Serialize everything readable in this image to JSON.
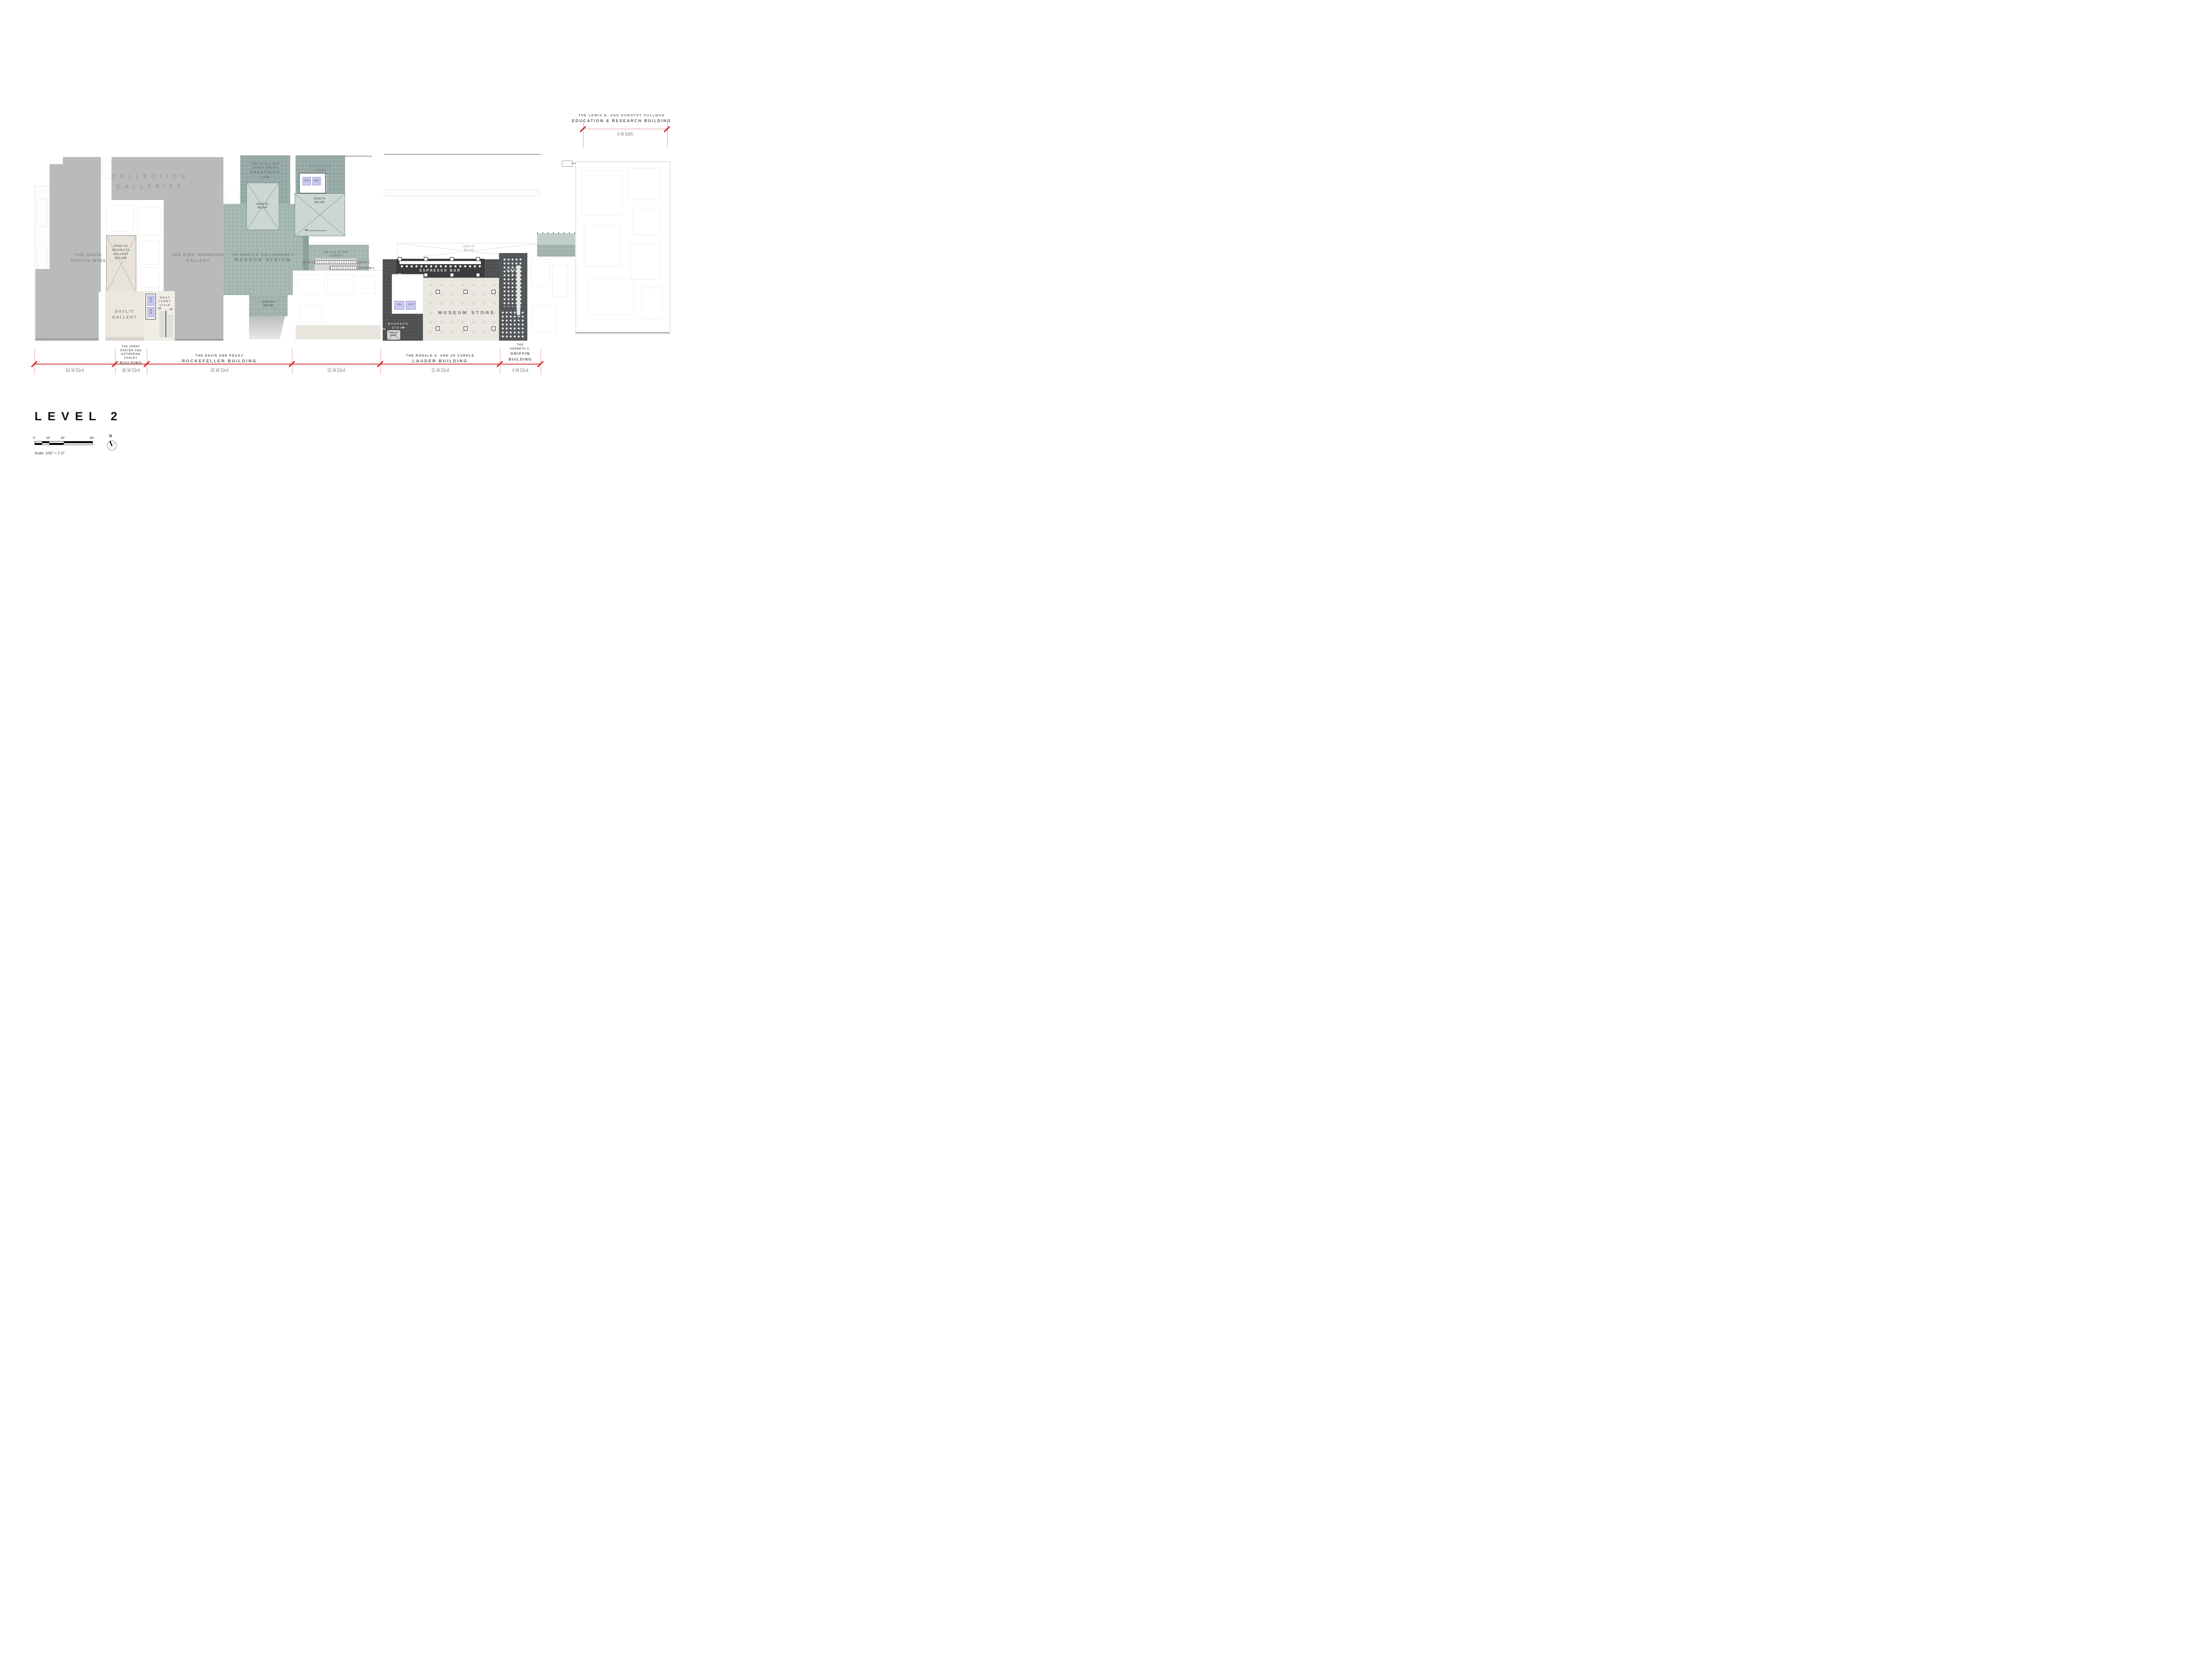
{
  "title": {
    "label": "LEVEL 2"
  },
  "legend": {
    "scale_ticks": [
      "0",
      "16'",
      "32'",
      "64'"
    ],
    "scale_note": "Scale: 1/32\" = 1'-0\"",
    "north": "N"
  },
  "cullman": {
    "line1": "THE LEWIS B. AND DOROTHY CULLMAN",
    "line2": "EDUCATION & RESEARCH BUILDING",
    "address": "4 W 54th"
  },
  "rooms": {
    "collection": {
      "l1": "COLLECTION",
      "l2": "GALLERIES"
    },
    "geffen": {
      "l1": "THE DAVID",
      "l2": "GEFFEN WING"
    },
    "varnedoe": {
      "l1": "THE KIRK VARNEDOE",
      "l2": "GALLERY"
    },
    "projects": {
      "l1": "OPEN TO",
      "l2": "PROJECTS",
      "l3": "GALLERY",
      "l4": "BELOW"
    },
    "creativity": {
      "l1": "THE PAULA AND",
      "l2": "JAMES CROWN",
      "l3": "CREATIVITY",
      "l4": "LAB"
    },
    "elevator_lobby": {
      "l1": "ELEVATOR",
      "l2": "LOBBY"
    },
    "marron": {
      "l1": "THE DONALD B. AND CATHERINE C.",
      "l2": "MARRON ATRIUM"
    },
    "escalator_lobby": {
      "l1": "ESCALATOR",
      "l2": "LOBBY"
    },
    "open_below": {
      "l1": "OPEN TO",
      "l2": "BELOW"
    },
    "daylit": {
      "l1": "DAYLIT",
      "l2": "GALLERY"
    },
    "west_stair": {
      "l1": "WEST",
      "l2": "LOBBY",
      "l3": "STAIR"
    },
    "espresso": "ESPRESSO BAR",
    "store": "MUSEUM STORE",
    "bauhaus": {
      "l1": "BAUHAUS",
      "l2": "STAIR"
    },
    "cafe": {
      "l1": "CAFE",
      "l2": "2"
    }
  },
  "circulation": {
    "up_to_3": "UP TO 3",
    "dn_to_1": "DN TO 1",
    "dn_from_3": "DN FROM 3",
    "dn": "DN",
    "up": "UP"
  },
  "elevators": {
    "pe5": "PE-5",
    "pe6": "PE-6",
    "pe8": "PE 8",
    "pe9": "PE 9",
    "pe20_l1": "PE",
    "pe20_l2": "20",
    "pe21_l1": "PE",
    "pe21_l2": "21"
  },
  "street": {
    "buildings": [
      {
        "address": "53 W 53rd"
      },
      {
        "address": "45 W 53rd",
        "l1": "THE JERRY",
        "l2": "SPEYER AND",
        "l3": "KATHERINE",
        "l4": "FARLEY",
        "l5": "BUILDING"
      },
      {
        "address": "25 W 53rd",
        "l1": "THE DAVID AND PEGGY",
        "l2": "ROCKEFELLER BUILDING"
      },
      {
        "address": "15 W 53rd"
      },
      {
        "address": "11 W 53rd",
        "l1": "THE RONALD S. AND JO CAROLE",
        "l2": "LAUDER BUILDING"
      },
      {
        "address": "9 W 53rd",
        "l1": "THE",
        "l2": "KENNETH C.",
        "l3": "GRIFFIN",
        "l4": "BUILDING"
      }
    ]
  },
  "colors": {
    "gallery_gray": "#b9bbba",
    "atrium_teal": "#a2b4b0",
    "lab_teal": "#93a8a4",
    "open_below_teal": "#ccd7d3",
    "wood": "#eae7e0",
    "dark_tile": "#4c4e4f",
    "espresso_dark": "#3a3c3d",
    "cafe_dark": "#55585a",
    "elevator_lavender": "#c9c8ee",
    "dimension_red": "#c92c2c",
    "label_gray": "#7c7e7d",
    "address_gray": "#a8aaac"
  }
}
